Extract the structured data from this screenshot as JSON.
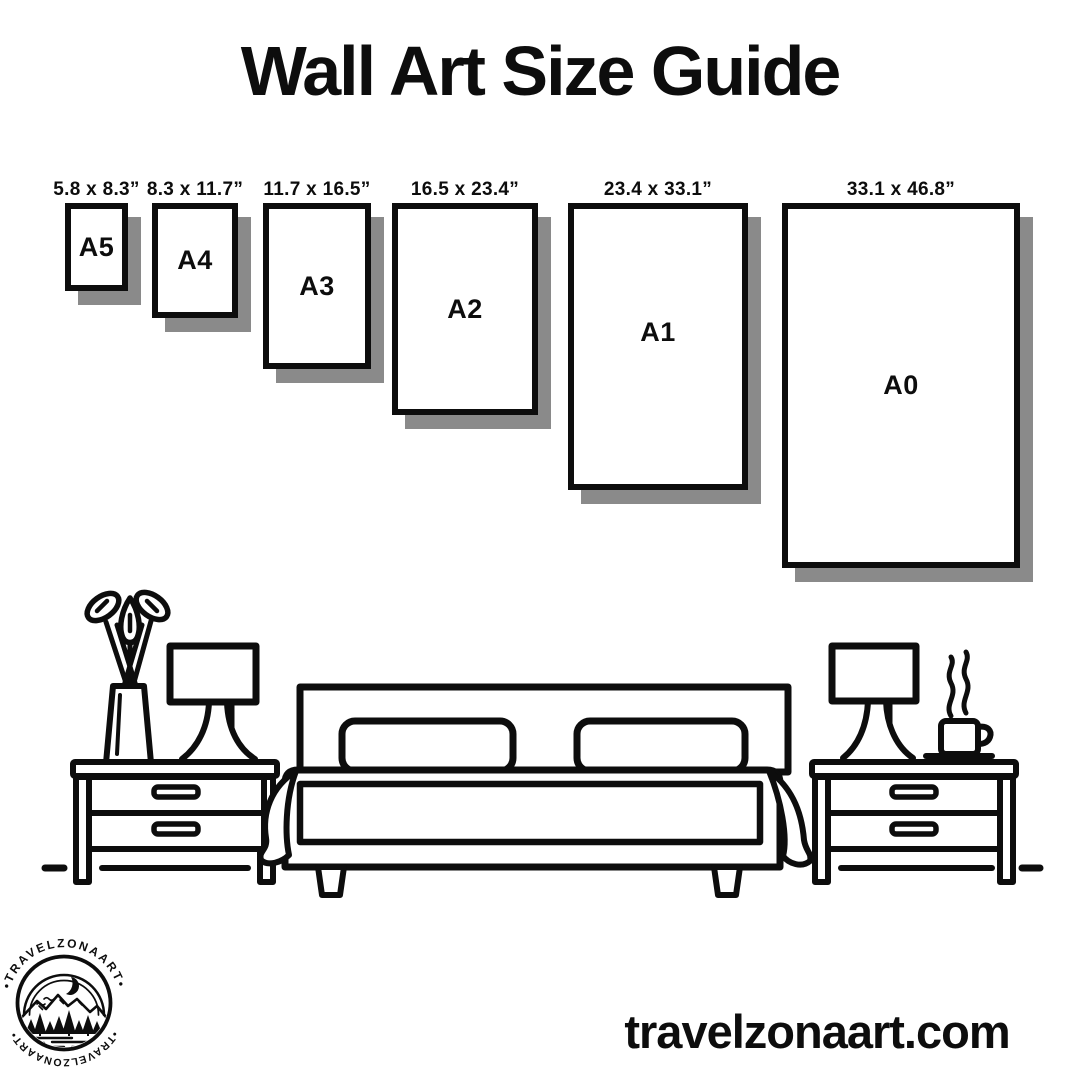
{
  "title": "Wall Art Size Guide",
  "papers": [
    {
      "name": "A5",
      "dims": "5.8 x 8.3”"
    },
    {
      "name": "A4",
      "dims": "8.3 x 11.7”"
    },
    {
      "name": "A3",
      "dims": "11.7 x 16.5”"
    },
    {
      "name": "A2",
      "dims": "16.5 x 23.4”"
    },
    {
      "name": "A1",
      "dims": "23.4 x 33.1”"
    },
    {
      "name": "A0",
      "dims": "33.1 x 46.8”"
    }
  ],
  "logo": {
    "arc_top": "•TRAVELZONAART•",
    "arc_bottom": "•TRAVELZONAART•"
  },
  "website": "travelzonaart.com",
  "colors": {
    "ink": "#0d0d0d",
    "paper_shadow": "#8a8a8a",
    "background": "#ffffff"
  },
  "scene": {
    "icons": [
      "plant-vase-icon",
      "table-lamp-icon",
      "bed-icon",
      "nightstand-icon",
      "coffee-cup-icon",
      "floor-line"
    ]
  }
}
